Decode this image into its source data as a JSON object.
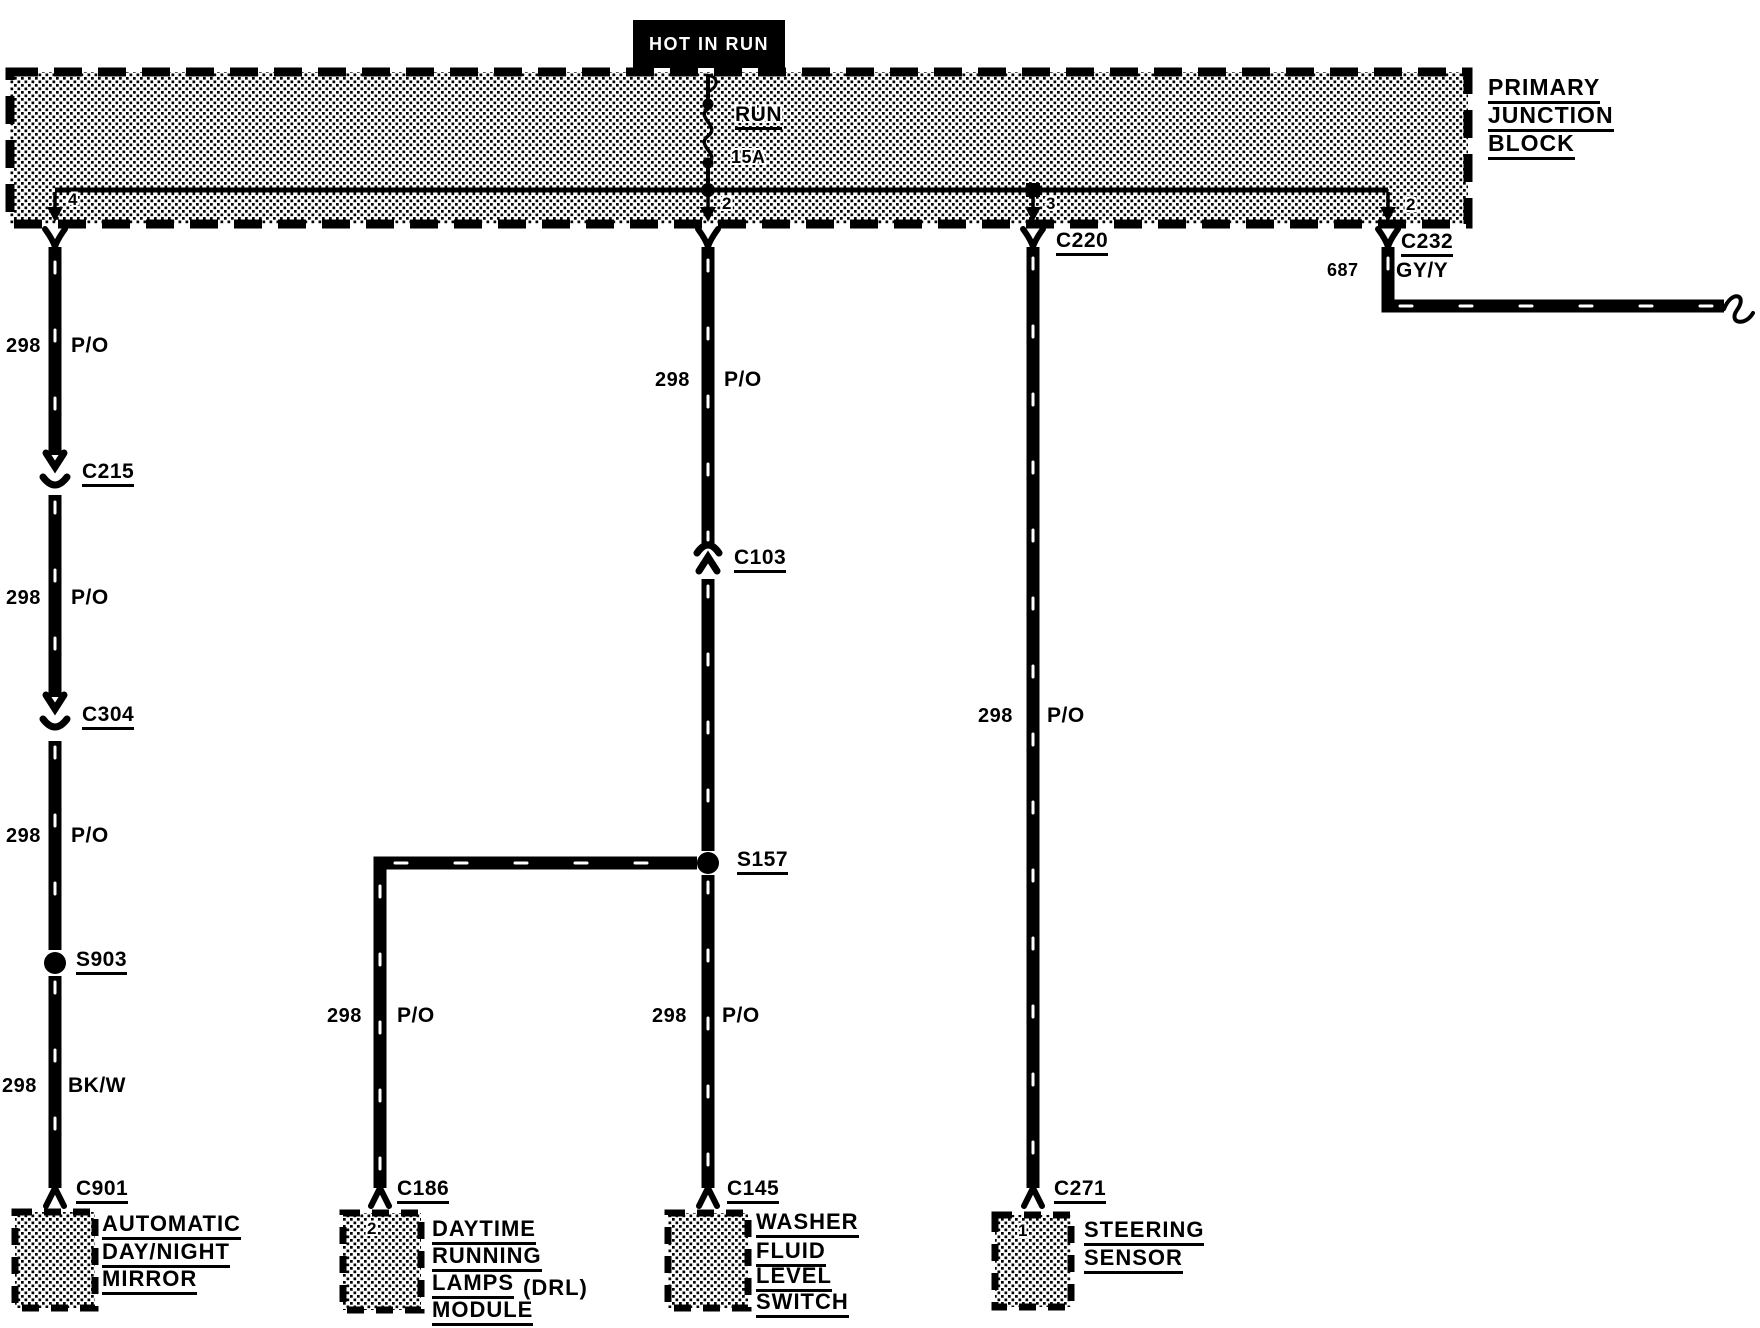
{
  "banner": {
    "label": "HOT IN RUN"
  },
  "junction_block": {
    "title_line1": "PRIMARY",
    "title_line2": "JUNCTION",
    "title_line3": "BLOCK",
    "switch_position": "RUN",
    "fuse_rating": "15A",
    "pin_left": "4",
    "pin_center": "2",
    "pin_inner_right": "3",
    "pin_outer_right": "2"
  },
  "left_branch": {
    "seg1": {
      "circuit": "298",
      "color": "P/O"
    },
    "connector1": "C215",
    "seg2": {
      "circuit": "298",
      "color": "P/O"
    },
    "connector2": "C304",
    "seg3": {
      "circuit": "298",
      "color": "P/O"
    },
    "splice": "S903",
    "seg4": {
      "circuit": "298",
      "color": "BK/W"
    },
    "connector3": "C901",
    "component": {
      "line1": "AUTOMATIC",
      "line2": "DAY/NIGHT",
      "line3": "MIRROR"
    }
  },
  "center_branch": {
    "seg1": {
      "circuit": "298",
      "color": "P/O"
    },
    "connector1": "C103",
    "splice": "S157",
    "seg2": {
      "circuit": "298",
      "color": "P/O"
    },
    "connector2": "C145",
    "component": {
      "line1": "WASHER",
      "line2": "FLUID",
      "line3": "LEVEL",
      "line4": "SWITCH"
    }
  },
  "drl_branch": {
    "seg1": {
      "circuit": "298",
      "color": "P/O"
    },
    "connector": "C186",
    "pin": "2",
    "component": {
      "line1": "DAYTIME",
      "line2": "RUNNING",
      "line3a": "LAMPS",
      "line3b": "(DRL)",
      "line4": "MODULE"
    }
  },
  "right_branch": {
    "connector": "C220",
    "seg1": {
      "circuit": "298",
      "color": "P/O"
    },
    "connector2": "C271",
    "pin": "1",
    "component": {
      "line1": "STEERING",
      "line2": "SENSOR"
    }
  },
  "offpage_branch": {
    "connector": "C232",
    "wire": {
      "circuit": "687",
      "color": "GY/Y"
    }
  }
}
